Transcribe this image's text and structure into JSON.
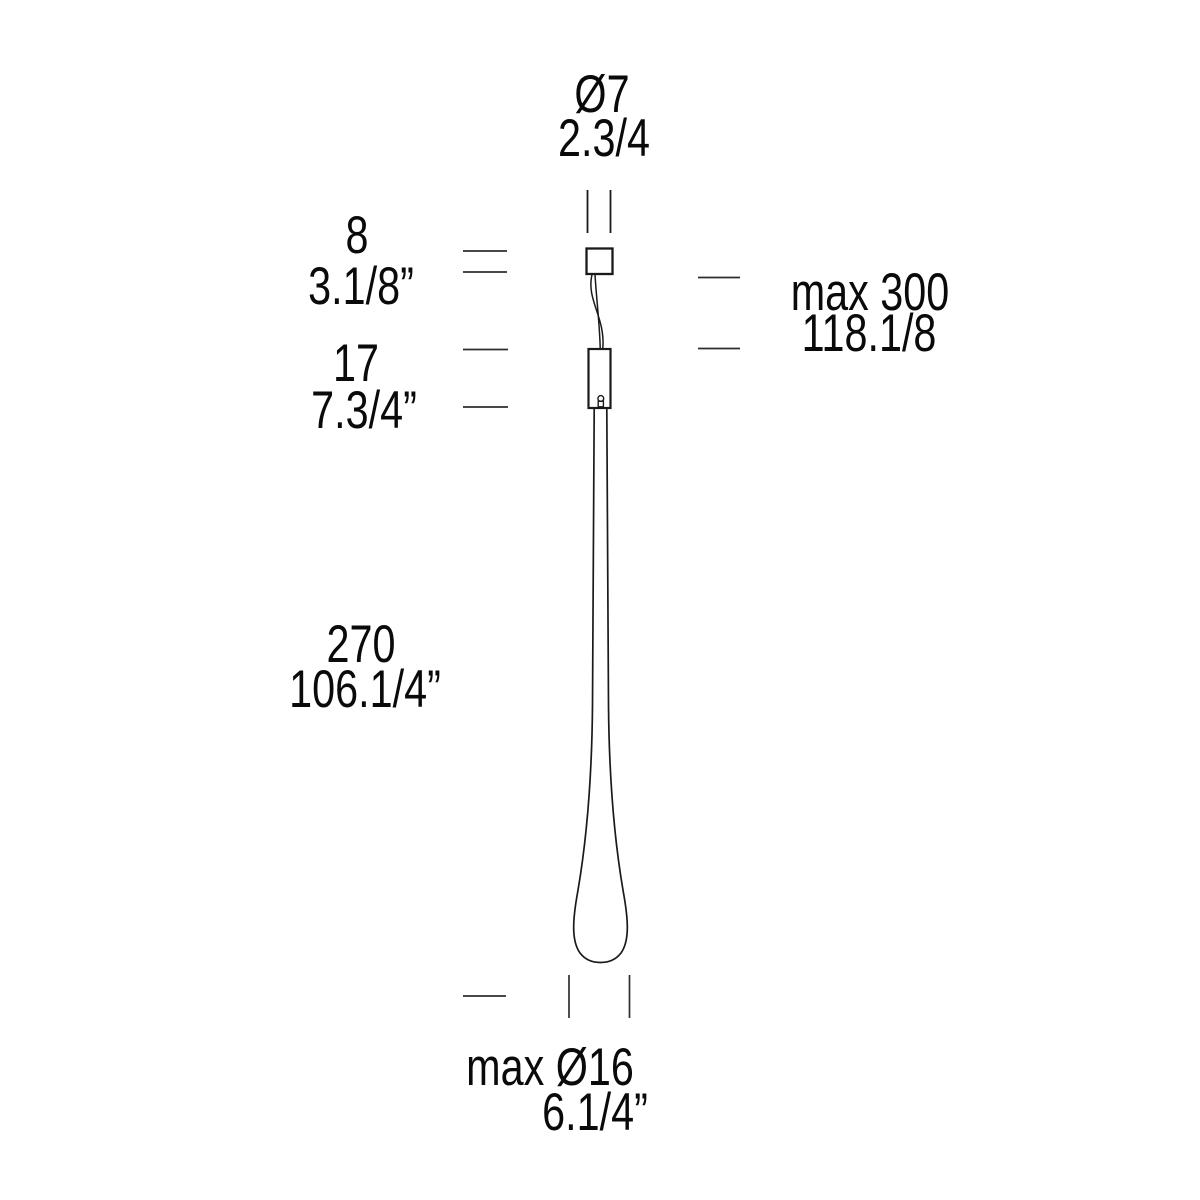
{
  "diagram": {
    "title": "pendant-lamp-dimension-drawing",
    "colors": {
      "background": "#ffffff",
      "line": "#1a1a1a",
      "tick": "#2e2e2e",
      "text": "#0a0a0a"
    },
    "labels": {
      "top_diameter": {
        "metric": "Ø7",
        "imperial": "2.3/4"
      },
      "canopy_height": {
        "metric": "8",
        "imperial": "3.1/8”"
      },
      "driver_height": {
        "metric": "17",
        "imperial": "7.3/4”"
      },
      "max_drop": {
        "metric": "max 300",
        "imperial": "118.1/8"
      },
      "glass_length": {
        "metric": "270",
        "imperial": "106.1/4”"
      },
      "max_diameter": {
        "metric": "max Ø16",
        "imperial": "6.1/4”"
      }
    }
  }
}
